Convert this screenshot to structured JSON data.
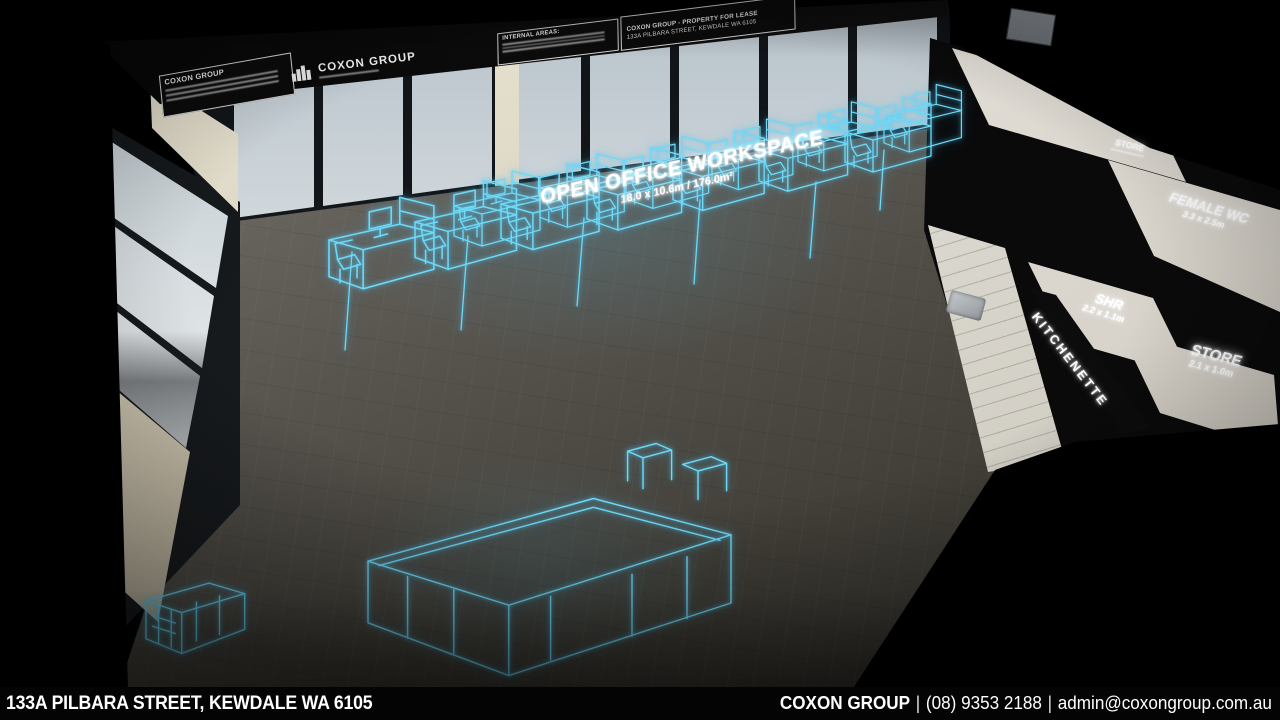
{
  "video": {
    "bottom_bar": {
      "address": "133A PILBARA STREET, KEWDALE WA 6105",
      "company": "COXON GROUP",
      "separator": "|",
      "phone": "(08) 9353 2188",
      "email": "admin@coxongroup.com.au"
    },
    "floor_overlay": {
      "workspace_title": "OPEN OFFICE WORKSPACE",
      "workspace_dims": "18.0 x 10.6m / 176.0m²"
    },
    "room_labels": {
      "store_top": {
        "label": "STORE"
      },
      "female_wc": {
        "label": "FEMALE WC",
        "dims": "3.3 x 2.5m"
      },
      "shr": {
        "label": "SHR",
        "dims": "2.2 x 1.1m"
      },
      "kitchenette": {
        "label": "KITCHENETTE"
      },
      "store": {
        "label": "STORE",
        "dims": "2.1 x 1.0m"
      }
    },
    "signage": {
      "board_contact": {
        "title": "COXON GROUP"
      },
      "board_logo": {
        "title": "COXON GROUP"
      },
      "board_areas": {
        "title": "INTERNAL AREAS:"
      },
      "board_lease": {
        "line1": "COXON GROUP - PROPERTY FOR LEASE",
        "line2": "133A PILBARA STREET, KEWDALE WA 6105"
      }
    },
    "colors": {
      "wireframe_cyan": "#6fd8f7",
      "label_glow": "#ffffff"
    }
  }
}
